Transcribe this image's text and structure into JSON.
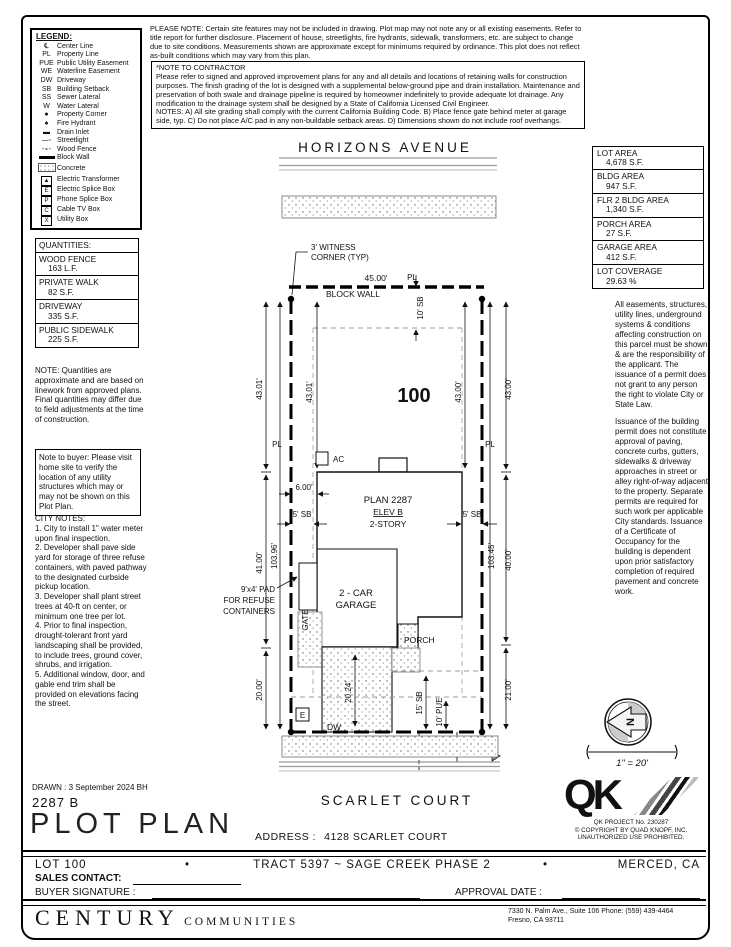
{
  "notices": {
    "please_note": "PLEASE NOTE:  Certain site features may not be included in drawing.  Plot map may not note any or all existing easements. Refer to title report for further disclosure.  Placement of house, streetlights, fire hydrants, sidewalk, transformers, etc. are subject to change due to site conditions.  Measurements shown are approximate except for minimums required by ordinance.  This plot does not reflect as-built conditions which may vary from this plan.",
    "contractor_title": "*NOTE TO CONTRACTOR",
    "contractor_body": "Please refer to signed and approved improvement plans for any and all details and locations of retaining walls for construction purposes. The finish grading of the lot is designed with a supplemental below-ground pipe and drain installation.  Maintenance and preservation of both swale and drainage pipeline is required by homeowner indefinitely to provide adequate lot drainage.  Any modification to the drainage system shall be designed by a State of California Licensed Civil Engineer.",
    "contractor_notes": "NOTES:  A) All site grading shall comply with the current California Building Code.  B) Place fence gate behind meter at garage side, typ.  C) Do not place A/C pad in any non-buildable setback areas.  D) Dimensions shown do not include roof overhangs."
  },
  "legend": {
    "title": "LEGEND:",
    "items": [
      {
        "sym": "℄",
        "label": "Center Line"
      },
      {
        "sym": "PL",
        "label": "Property Line"
      },
      {
        "sym": "PUE",
        "label": "Public Utility Easement"
      },
      {
        "sym": "WE",
        "label": "Waterline Easement"
      },
      {
        "sym": "DW",
        "label": "Driveway"
      },
      {
        "sym": "SB",
        "label": "Building Setback"
      },
      {
        "sym": "SS",
        "label": "Sewer Lateral"
      },
      {
        "sym": "W",
        "label": "Water Lateral"
      },
      {
        "sym": "●",
        "label": "Property Corner"
      },
      {
        "sym": "♠",
        "label": "Fire Hydrant"
      },
      {
        "sym": "▬",
        "label": "Drain Inlet"
      },
      {
        "sym": "",
        "label": "Streetlight"
      },
      {
        "sym": "",
        "label": "Wood Fence"
      },
      {
        "sym": "",
        "label": "Block Wall"
      },
      {
        "sym": "",
        "label": "Concrete"
      },
      {
        "sym": "▲",
        "label": "Electric Transformer"
      },
      {
        "sym": "E",
        "label": "Electric Splice Box"
      },
      {
        "sym": "P",
        "label": "Phone Splice Box"
      },
      {
        "sym": "C",
        "label": "Cable TV Box"
      },
      {
        "sym": "X",
        "label": "Utility Box"
      }
    ]
  },
  "areas": [
    {
      "label": "LOT AREA",
      "value": "4,678 S.F."
    },
    {
      "label": "BLDG AREA",
      "value": "947 S.F."
    },
    {
      "label": "FLR 2 BLDG AREA",
      "value": "1,340 S.F."
    },
    {
      "label": "PORCH AREA",
      "value": "27 S.F."
    },
    {
      "label": "GARAGE AREA",
      "value": "412 S.F."
    },
    {
      "label": "LOT COVERAGE",
      "value": "29.63 %"
    }
  ],
  "quantities": {
    "title": "QUANTITIES:",
    "items": [
      {
        "label": "WOOD FENCE",
        "value": "163 L.F."
      },
      {
        "label": "PRIVATE WALK",
        "value": "82 S.F."
      },
      {
        "label": "DRIVEWAY",
        "value": "335 S.F."
      },
      {
        "label": "PUBLIC SIDEWALK",
        "value": "225 S.F."
      }
    ],
    "note": "NOTE: Quantities are approximate and are based on linework from approved plans.  Final quantities may differ due to field adjustments at the time of construction."
  },
  "buyer_note": "Note to buyer: Please visit home site to verify the location of any utility structures which may or may not be shown on this Plot Plan.",
  "city_notes": {
    "title": "CITY NOTES:",
    "body": "1. City to install 1\" water meter upon final inspection.\n2. Developer shall pave side yard for storage of three refuse containers, with paved pathway to the designated curbside pickup location.\n3. Developer shall plant street trees at 40-ft on center, or minimum one tree per lot.\n4. Prior to final inspection, drought-tolerant front yard landscaping shall be provided, to include trees, ground cover, shrubs, and irrigation.\n5. Additional window, door, and gable end trim shall be provided on elevations facing the street."
  },
  "right_paragraphs": {
    "p1": "All easements, structures, utility lines, underground systems & conditions affecting construction on this parcel must be shown & are the responsibility of the applicant. The issuance of a permit does not grant to any person the right to violate City or State Law.",
    "p2": "Issuance of the building permit does not constitute approval of paving, concrete curbs, gutters, sidewalks & driveway approaches in street or alley right-of-way adjacent to the property. Separate permits are required for such work per applicable City standards. Issuance of a Certificate of Occupancy for the building is dependent upon prior satisfactory completion of required pavement and concrete work."
  },
  "plot": {
    "street_top": "HORIZONS AVENUE",
    "street_bottom": "SCARLET COURT",
    "lot_number": "100",
    "witness1": "3' WITNESS",
    "witness2": "CORNER (TYP)",
    "block_wall": "BLOCK WALL",
    "plan": "PLAN 2287",
    "elev": "ELEV B",
    "story": "2-STORY",
    "garage1": "2 - CAR",
    "garage2": "GARAGE",
    "porch": "PORCH",
    "gate": "GATE",
    "ac": "AC",
    "dw": "DW",
    "e_box": "E",
    "refuse1": "9'x4' PAD",
    "refuse2": "FOR REFUSE",
    "refuse3": "CONTAINERS",
    "pl": "PL",
    "ss": "SS",
    "w": "W",
    "dims": {
      "front_width": "45.00'",
      "rear_width": "45.00'",
      "front_sb": "10' SB",
      "left_outer_a": "43.01'",
      "left_inner": "43.01'",
      "right_outer_a": "43.00'",
      "right_inner": "43.00'",
      "left_outer_b": "41.00'",
      "left_depth": "103.96'",
      "right_depth": "103.45'",
      "right_outer_b": "40.00'",
      "left_outer_c": "20.00'",
      "right_outer_c": "21.00'",
      "drive_len": "20.24'",
      "side_gap": "6.00'",
      "side_sb_left": "5' SB",
      "side_sb_right": "5' SB",
      "rear_sb": "15' SB",
      "pue": "10' PUE"
    }
  },
  "compass": {
    "n": "N",
    "scale": "1\" = 20'"
  },
  "qk": {
    "project": "QK PROJECT No. 230287",
    "copyright": "© COPYRIGHT BY QUAD KNOPF, INC.",
    "note": "UNAUTHORIZED USE PROHIBITED.",
    "logo": "QK"
  },
  "title_block": {
    "drawn": "DRAWN : 3 September 2024  BH",
    "plan_code": "2287 B",
    "title": "PLOT PLAN",
    "address_label": "ADDRESS :",
    "address": "4128 SCARLET COURT"
  },
  "footer": {
    "lot": "LOT 100",
    "bullet": "•",
    "tract": "TRACT 5397 ~ SAGE CREEK PHASE 2",
    "city": "MERCED, CA",
    "sales_label": "SALES CONTACT:",
    "buyer_label": "BUYER SIGNATURE :",
    "approval_label": "APPROVAL DATE :",
    "brand": "CENTURY",
    "brand_sub": "COMMUNITIES",
    "office1": "7330 N. Palm Ave., Suite 106    Phone:  (559) 439-4464",
    "office2": "Fresno, CA  93711"
  }
}
